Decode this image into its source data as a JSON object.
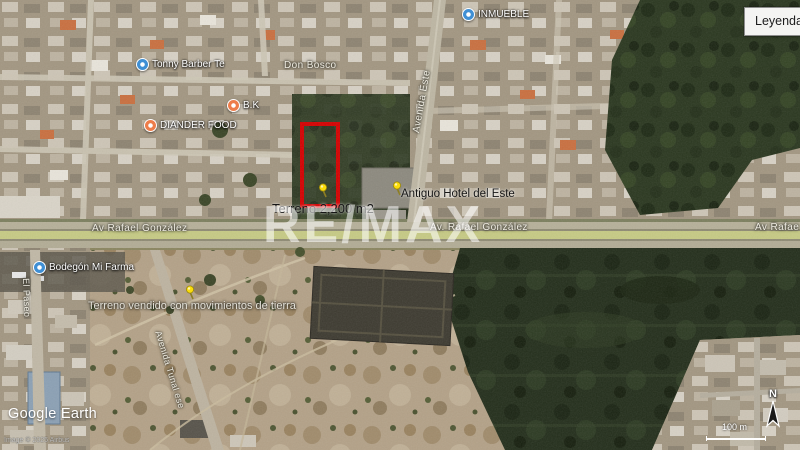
{
  "legend": {
    "title": "Leyenda"
  },
  "watermark": "RE/MAX",
  "annotations": {
    "property_area": "Terreno 2,200 m2",
    "hotel": "Antiguo Hotel del Este",
    "sold_land": "Terreno vendido con movimientos de tierra"
  },
  "streets": {
    "av_rafael_left": "Av Rafael González",
    "av_rafael_center": "Av. Rafael González",
    "av_rafael_right": "Av Rafae",
    "avenida_este": "Avenida Este",
    "don_bosco": "Don Bosco",
    "el_paseo": "El Paseo",
    "avenida_tunal": "Avenida Tunal ese"
  },
  "pois": [
    {
      "name": "INMUEBLE",
      "type": "blue"
    },
    {
      "name": "Tonny Barber Te",
      "type": "blue"
    },
    {
      "name": "B.K",
      "type": "orange"
    },
    {
      "name": "DIANDER FOOD",
      "type": "orange"
    },
    {
      "name": "Bodegón Mi Farma",
      "type": "blue"
    }
  ],
  "attribution": {
    "logo": "Google Earth",
    "imagery": "Image © 2025 Airbus"
  },
  "map_controls": {
    "scale_label": "100 m",
    "compass_label": "N"
  },
  "colors": {
    "property_outline": "#d40000",
    "pushpin": "#ffdf00",
    "poi_blue": "#3f8fd4",
    "poi_orange": "#ee7d4a",
    "road_median": "#c6ca84",
    "forest": "#2a371f"
  }
}
